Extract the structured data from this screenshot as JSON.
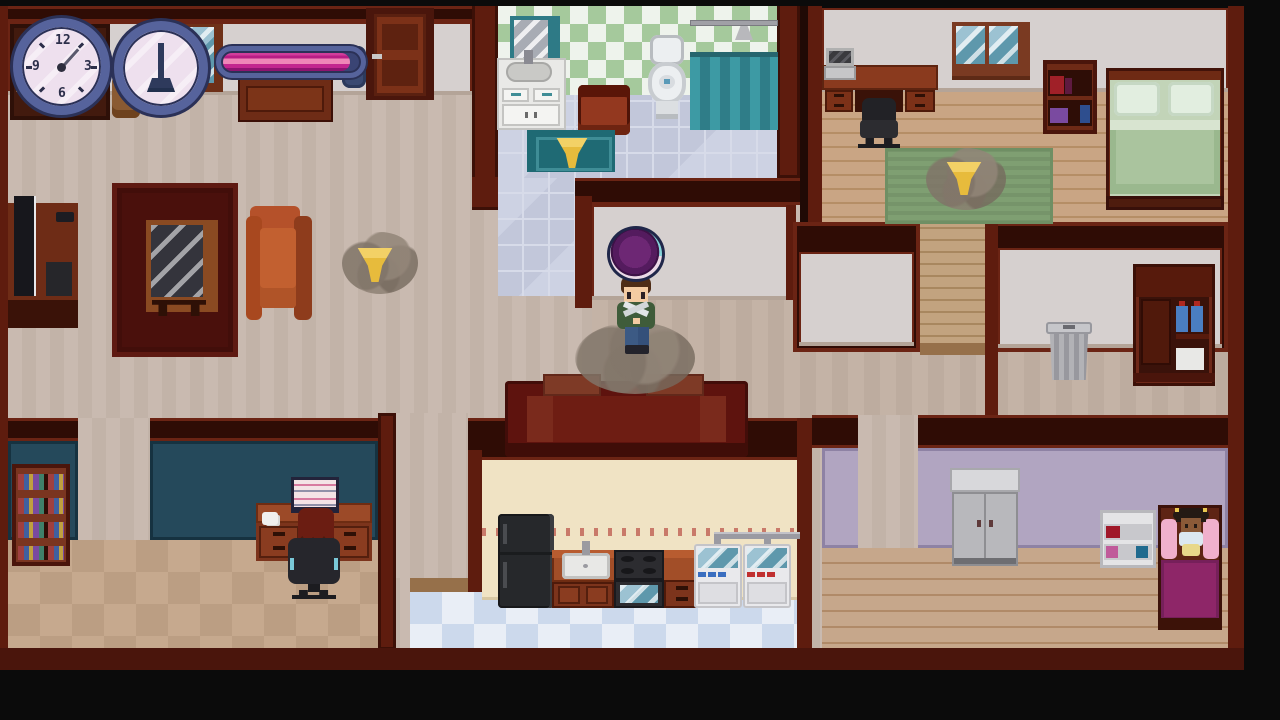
{
  "scene": {
    "app": "pixel-art house cleaning game",
    "view": "top-down cutaway of a two-story-style house interior",
    "rooms": [
      {
        "name": "entry-hall-living-room",
        "furniture": [
          "grandfather-clock-cabinet",
          "small-window",
          "stool",
          "dresser",
          "entry-door",
          "blue-wall-hanging",
          "tv-stand",
          "tv",
          "game-console",
          "remote",
          "red-rug",
          "glass-table",
          "orange-armchair"
        ]
      },
      {
        "name": "bathroom",
        "furniture": [
          "mirror",
          "sink-vanity",
          "laundry-hamper",
          "toilet",
          "shower-rail",
          "shower-head",
          "shower-curtain",
          "bath-mat"
        ]
      },
      {
        "name": "master-bedroom",
        "furniture": [
          "desk",
          "laptop",
          "office-chair",
          "window",
          "bookshelf",
          "double-bed",
          "green-rug"
        ]
      },
      {
        "name": "center-hallway",
        "furniture": [
          "red-couch"
        ]
      },
      {
        "name": "storage-hallway",
        "furniture": [
          "trash-can",
          "supply-cabinet",
          "blue-bottles",
          "white-box"
        ]
      },
      {
        "name": "office",
        "furniture": [
          "bookshelf",
          "desk",
          "computer-monitor",
          "coffee-cup",
          "office-chair"
        ]
      },
      {
        "name": "kitchen-laundry",
        "furniture": [
          "fridge",
          "counter",
          "kitchen-sink",
          "stove-oven",
          "cabinets",
          "washing-machine-1",
          "washing-machine-2",
          "pipes"
        ]
      },
      {
        "name": "kids-room",
        "furniture": [
          "wardrobe",
          "white-shelf",
          "kids-bed",
          "pink-pillows"
        ]
      }
    ],
    "characters": [
      {
        "name": "player",
        "look": "brown hair, green jacket, blue jeans",
        "state": "standing in dust cloud under purple bubble"
      },
      {
        "name": "npc-office-worker",
        "look": "dark red hair, black office chair",
        "state": "sitting at computer"
      },
      {
        "name": "npc-child",
        "look": "dark skin, pigtail buns",
        "state": "sitting on bed between pink pillows"
      }
    ],
    "markers": [
      {
        "name": "dust-pile-living-room",
        "icon": "yellow-triangle"
      },
      {
        "name": "dust-pile-bath-mat",
        "icon": "yellow-triangle"
      },
      {
        "name": "dust-pile-bedroom-rug",
        "icon": "yellow-triangle"
      },
      {
        "name": "dust-cloud-player-feet",
        "icon": "dust-cloud"
      },
      {
        "name": "magic-bubble",
        "icon": "purple-orb"
      }
    ]
  },
  "hud": {
    "wall_clock": {
      "numerals": [
        "12",
        "3",
        "6",
        "9"
      ],
      "hand_angle_deg": 42
    },
    "chore_timer": {
      "icon": "broom"
    },
    "progress_bar": {
      "percent": 91
    }
  },
  "palette": {
    "wall-maroon": "#5e1c0e",
    "wall-dark": "#2f0c05",
    "wall-gray": "#d6d0cf",
    "office-teal": "#25495b",
    "kitchen-cream": "#f0e3c4",
    "child-lavender": "#b1a5c1",
    "hud-blue": "#56639c",
    "progress-magenta": "#c3268f",
    "progress-pink": "#ef86b8",
    "triangle-yellow": "#e7bb3c",
    "orb-purple": "#5c1f63",
    "couch-red": "#5e130e"
  }
}
